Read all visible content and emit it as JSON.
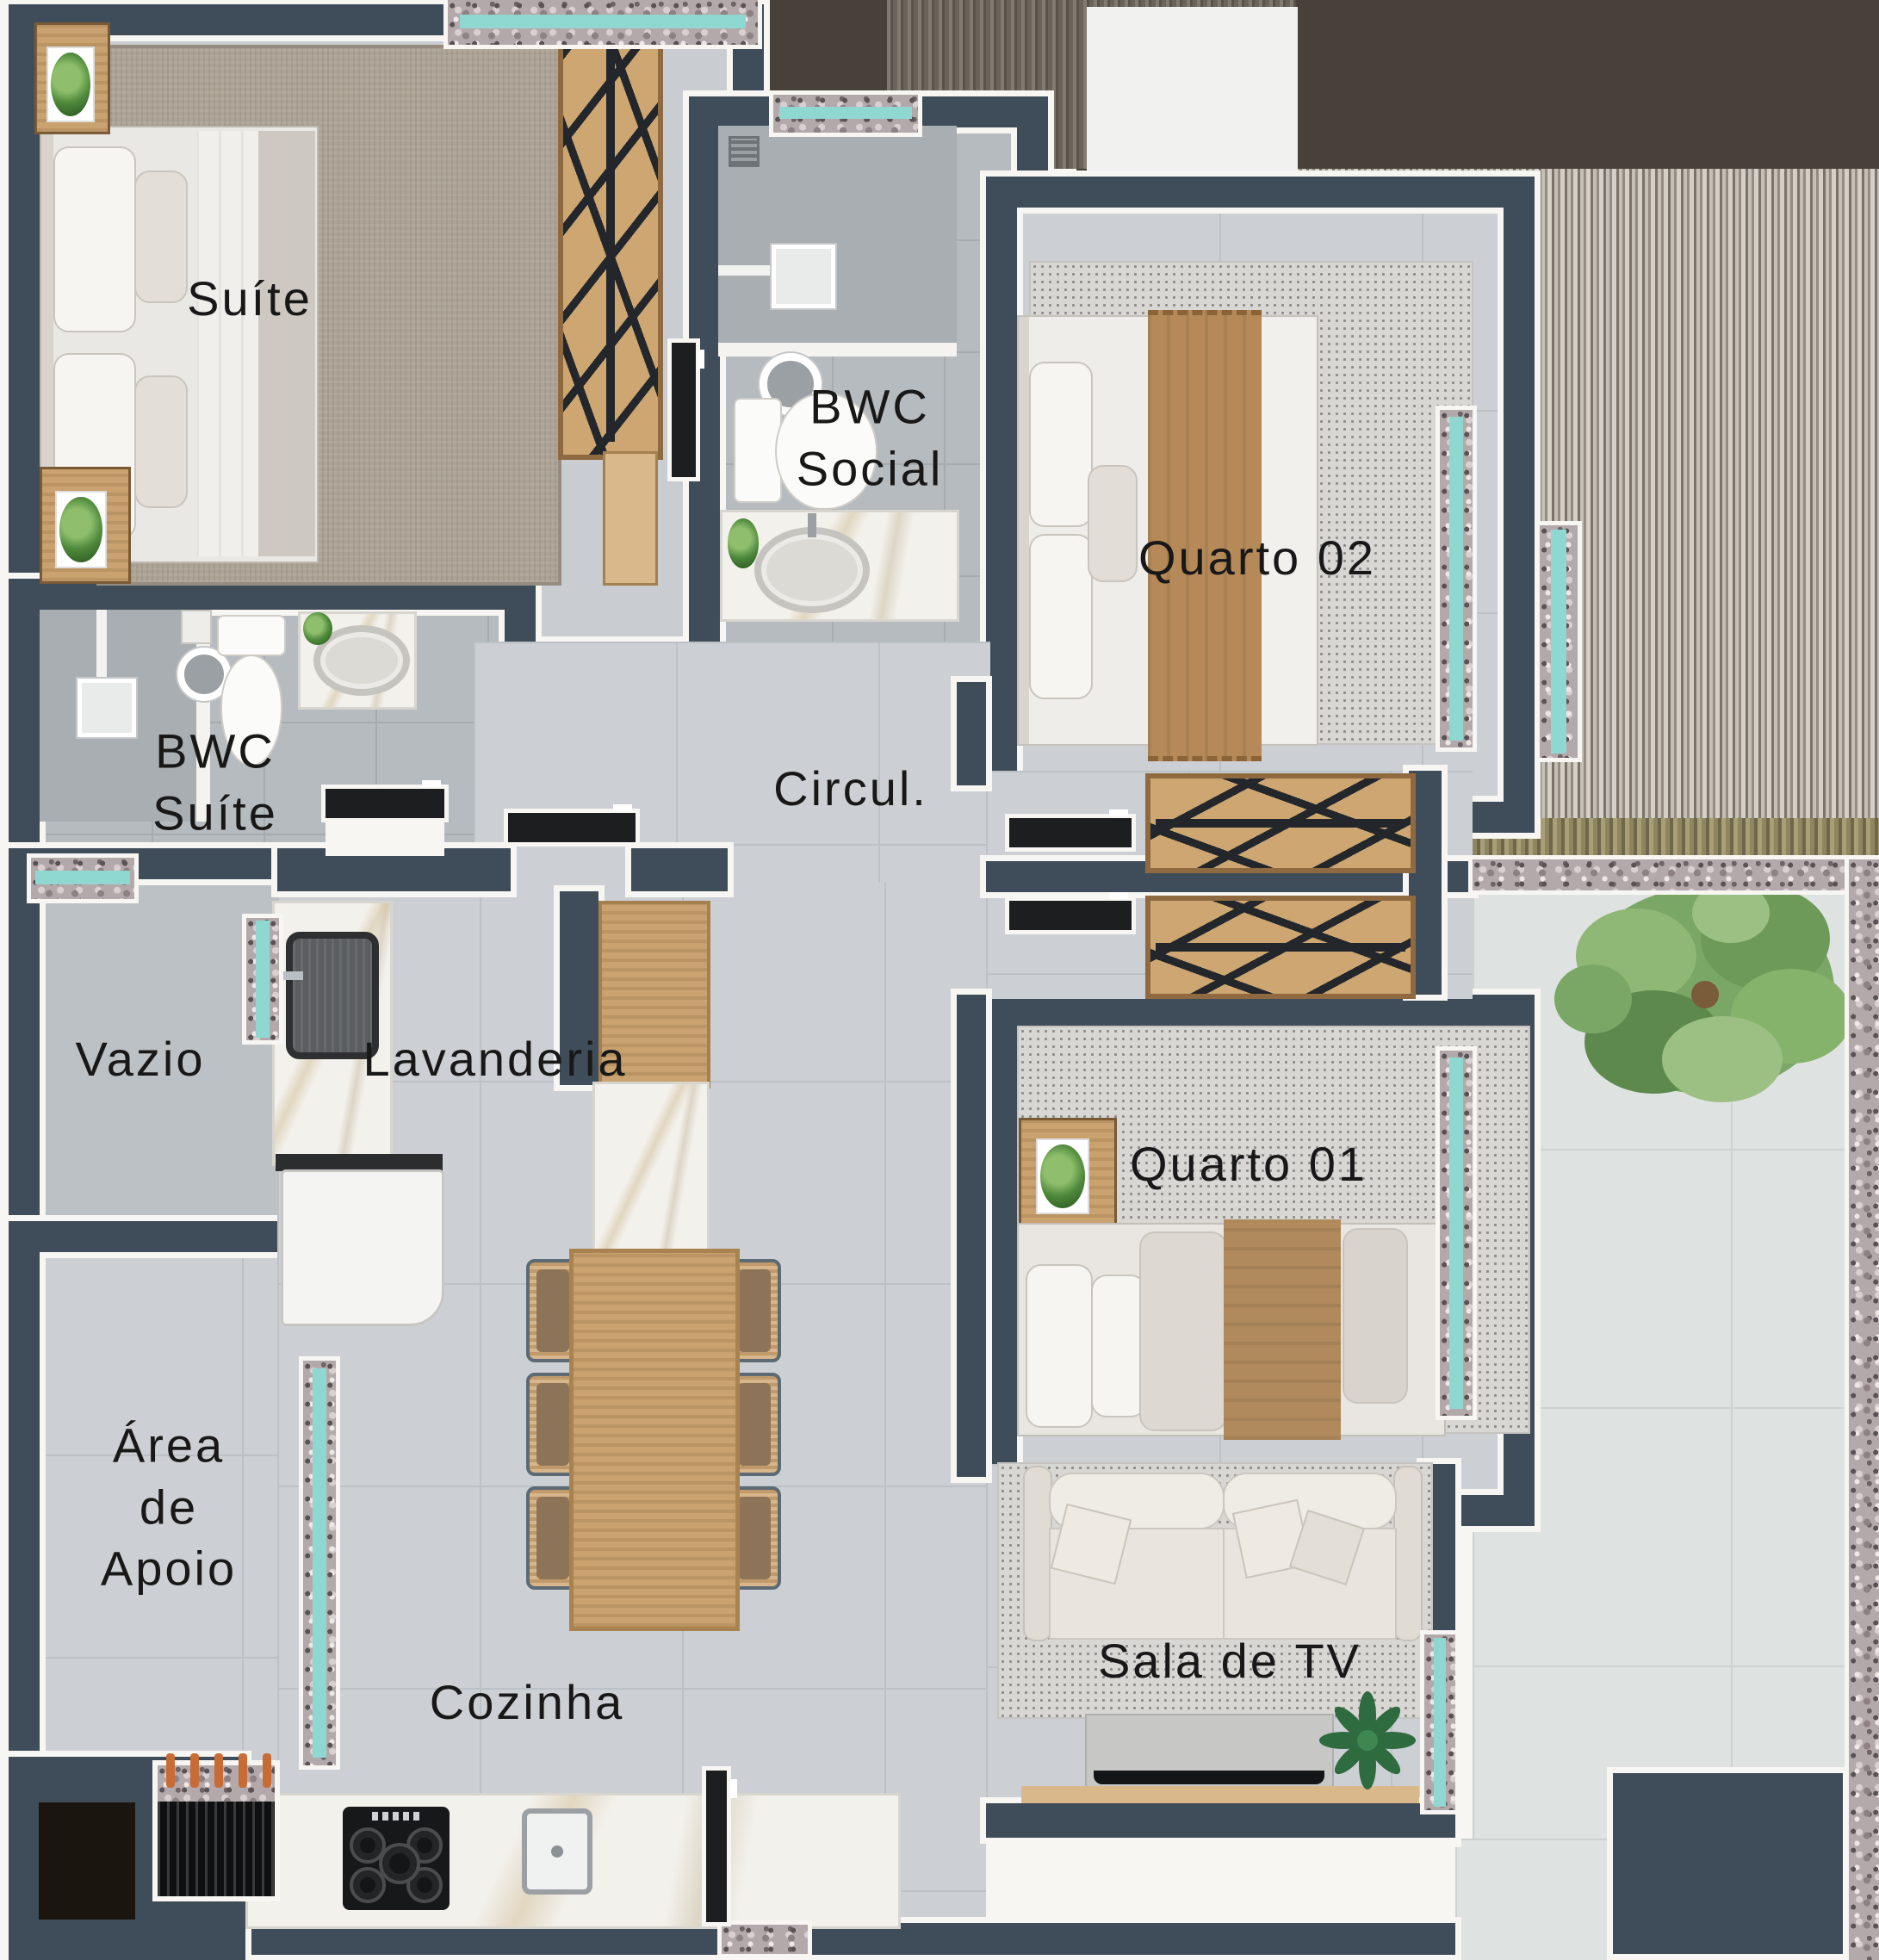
{
  "plan": {
    "type": "apartment-floor-plan",
    "labels": {
      "suite": "Suíte",
      "bwc_social": [
        "BWC",
        "Social"
      ],
      "quarto_02": "Quarto 02",
      "bwc_suite": [
        "BWC",
        "Suíte"
      ],
      "circulacao": "Circul.",
      "vazio": "Vazio",
      "lavanderia": "Lavanderia",
      "quarto_01": "Quarto 01",
      "area_de_apoio": [
        "Área",
        "de",
        "Apoio"
      ],
      "cozinha": "Cozinha",
      "sala_de_tv": "Sala de TV"
    },
    "colors": {
      "wall": "#3f4c59",
      "wall_outline": "#f7f6f3",
      "floor_tile": "#ccd0d4",
      "floor_bath": "#b6bbc0",
      "rug_beige": "#aca395",
      "rug_dotted": "#d8d7d3",
      "wood": "#c9a26f",
      "marble": "#f3f1ec",
      "granite": "#b3a8aa",
      "window_glass": "#8fd8d2",
      "exterior_dark": "#48413a",
      "door": "#1c1e20",
      "label_text": "#181818",
      "foliage": "#7aa765"
    }
  }
}
